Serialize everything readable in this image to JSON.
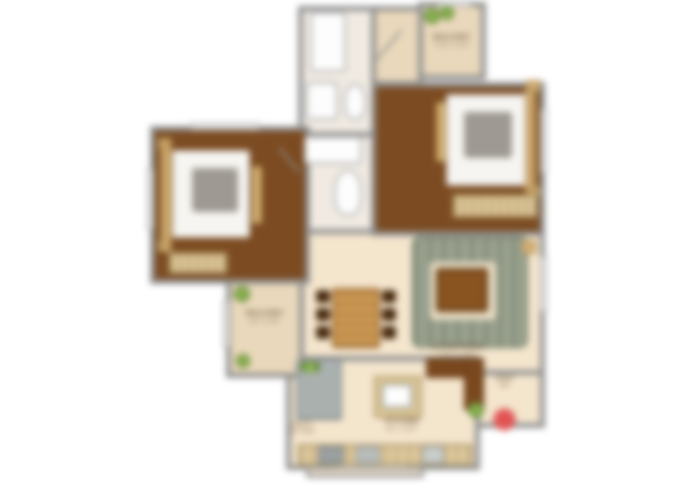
{
  "image_type": "blurred-2bhk-apartment-floor-plan",
  "colors": {
    "background": "#ffffff",
    "wall": "#8f8f8f",
    "bedroom_floor": "#7c4b21",
    "living_floor": "#f4e5cd",
    "balcony_floor": "#e9d8bb",
    "bath_floor": "#f0eae2",
    "wardrobe_wood": "#dcc79c",
    "sofa": "#9aa28f",
    "rug": "#8a5420",
    "plant": "#6f9a3a",
    "accent_red_dot": "#e25454",
    "label_text": "#6b543a"
  },
  "rooms": {
    "balcony_top": {
      "name": "BALCONY",
      "dims": "7'10\" X 4'0\""
    },
    "balcony_left": {
      "name": "BALCONY",
      "dims": "4'0\" X 9'6\""
    },
    "living": {
      "name": "LIVING ROOM",
      "dims": "11'6\" X 15'0\""
    },
    "kitchen": {
      "name": "KITCHEN",
      "dims": "8'0\" X 8'6\""
    },
    "utility": {
      "name": "UTILITY",
      "dims": "3'0\" X 4'0\""
    },
    "entry": {
      "name": "ENTRY",
      "dims": "4'0\""
    }
  }
}
